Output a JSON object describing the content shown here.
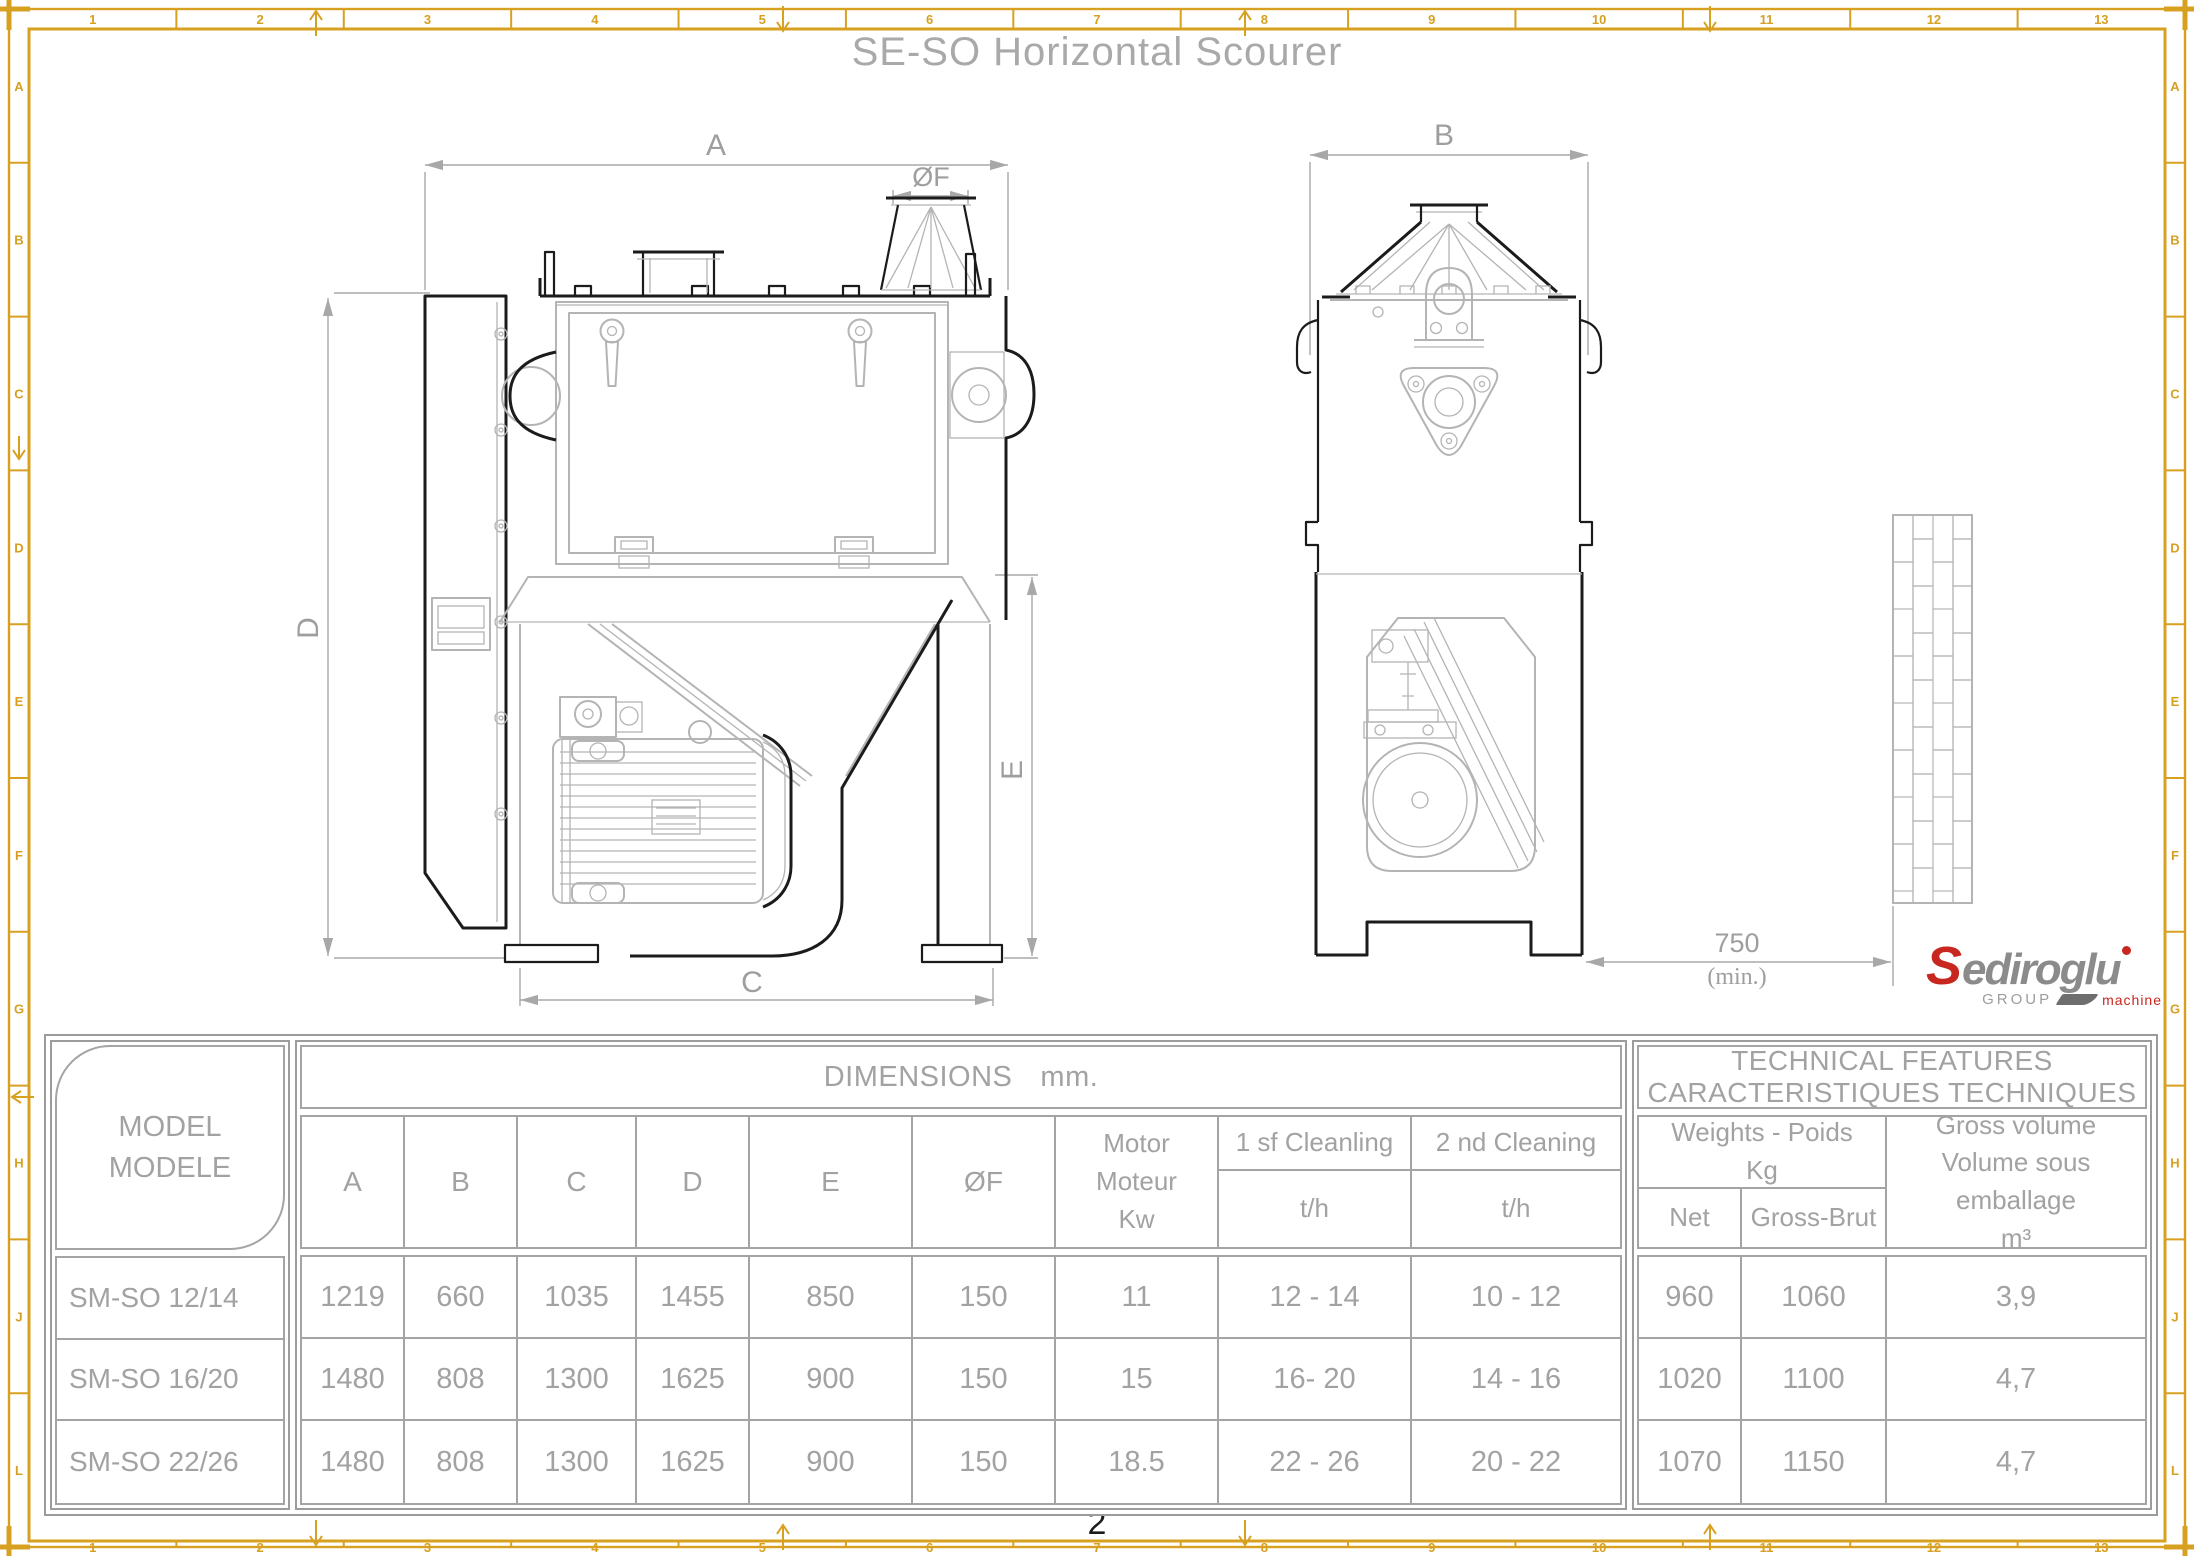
{
  "sheet": {
    "title": "SE-SO Horizontal Scourer",
    "page_number": "2"
  },
  "frame": {
    "column_labels": [
      "1",
      "2",
      "3",
      "4",
      "5",
      "6",
      "7",
      "8",
      "9",
      "10",
      "11",
      "12",
      "13"
    ],
    "row_labels": [
      "A",
      "B",
      "C",
      "D",
      "E",
      "F",
      "G",
      "H",
      "J",
      "L"
    ],
    "color": "#d7a021"
  },
  "drawing": {
    "dims": {
      "a": "A",
      "b": "B",
      "c": "C",
      "d": "D",
      "e": "E",
      "f": "ØF",
      "clearance": "750",
      "clearance_min": "(min.)"
    }
  },
  "logo": {
    "brand_initial": "S",
    "brand_rest": "ediroglu",
    "group": "GROUP",
    "machine": "machine",
    "accent_color": "#c8271f"
  },
  "table": {
    "model_header_line1": "MODEL",
    "model_header_line2": "MODELE",
    "dimensions_label": "DIMENSIONS",
    "dimensions_unit": "mm.",
    "tech_header_line1": "TECHNICAL FEATURES",
    "tech_header_line2": "CARACTERISTIQUES TECHNIQUES",
    "col_a": "A",
    "col_b": "B",
    "col_c": "C",
    "col_d": "D",
    "col_e": "E",
    "col_f": "ØF",
    "motor_line1": "Motor",
    "motor_line2": "Moteur",
    "motor_line3": "Kw",
    "cleaning1": "1 sf Cleanling",
    "cleaning2": "2 nd Cleaning",
    "th": "t/h",
    "weights_line1": "Weights - Poids",
    "weights_line2": "Kg",
    "net": "Net",
    "gross": "Gross-Brut",
    "volume_line1": "Gross volume",
    "volume_line2": "Volume sous",
    "volume_line3": "emballage",
    "volume_line4": "m³",
    "rows": [
      {
        "model": "SM-SO 12/14",
        "a": "1219",
        "b": "660",
        "c": "1035",
        "d": "1455",
        "e": "850",
        "f": "150",
        "motor": "11",
        "clean1": "12 - 14",
        "clean2": "10 - 12",
        "net": "960",
        "gross": "1060",
        "volume": "3,9"
      },
      {
        "model": "SM-SO 16/20",
        "a": "1480",
        "b": "808",
        "c": "1300",
        "d": "1625",
        "e": "900",
        "f": "150",
        "motor": "15",
        "clean1": "16- 20",
        "clean2": "14 - 16",
        "net": "1020",
        "gross": "1100",
        "volume": "4,7"
      },
      {
        "model": "SM-SO 22/26",
        "a": "1480",
        "b": "808",
        "c": "1300",
        "d": "1625",
        "e": "900",
        "f": "150",
        "motor": "18.5",
        "clean1": "22 - 26",
        "clean2": "20 - 22",
        "net": "1070",
        "gross": "1150",
        "volume": "4,7"
      }
    ]
  }
}
